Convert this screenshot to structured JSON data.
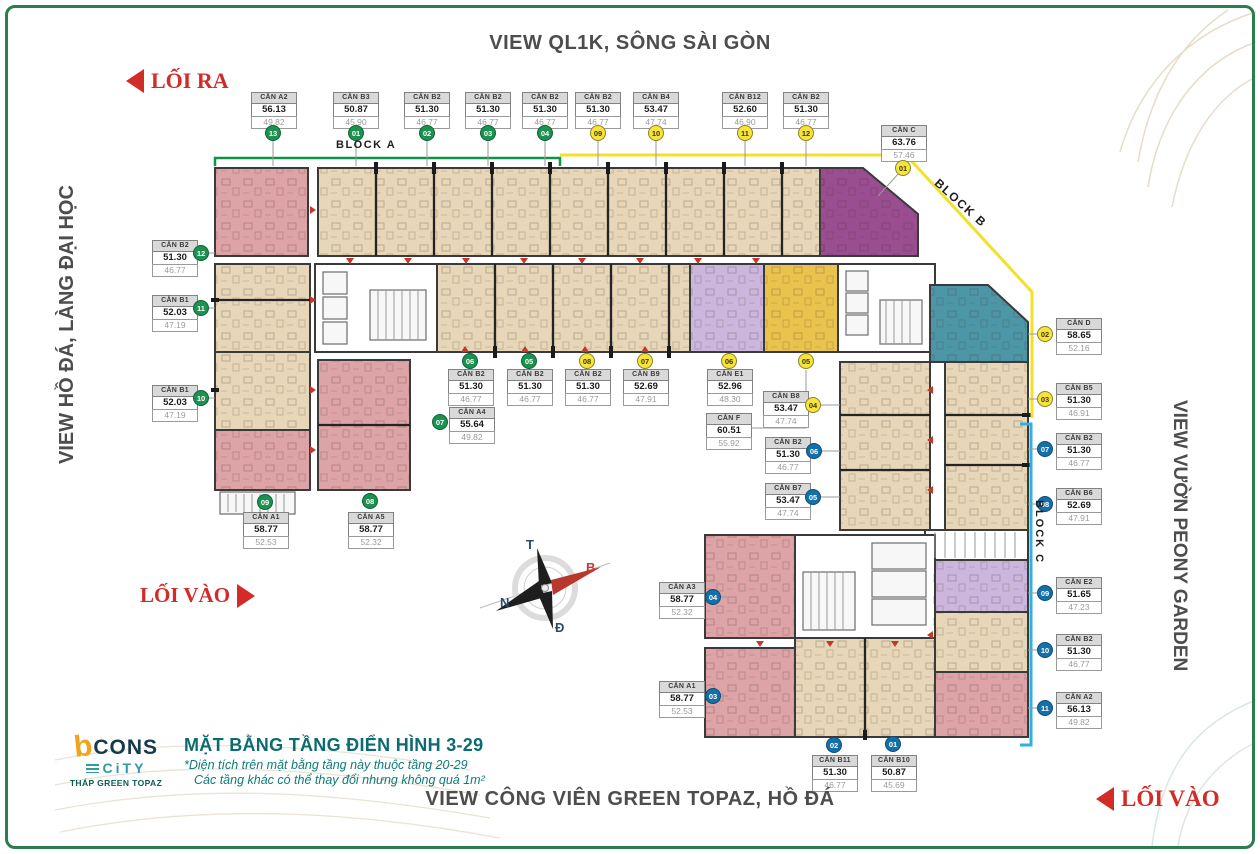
{
  "titles": {
    "top": "VIEW QL1K, SÔNG SÀI GÒN",
    "bottom": "VIEW CÔNG VIÊN GREEN TOPAZ, HỒ ĐÁ",
    "left": "VIEW HỒ ĐÁ, LÀNG ĐẠI HỌC",
    "right": "VIEW VƯỜN PEONY GARDEN"
  },
  "arrows": {
    "exit_top_left": "LỐI RA",
    "entry_left": "LỐI VÀO",
    "entry_bottom_right": "LỐI VÀO"
  },
  "blocks": {
    "a": {
      "label": "BLOCK A",
      "color": "#0f9347"
    },
    "b": {
      "label": "BLOCK B",
      "color": "#f2e02a"
    },
    "c": {
      "label": "BLOCK C",
      "color": "#2fb0e2"
    }
  },
  "compass": {
    "t": "T",
    "b": "B",
    "n": "N",
    "d": "Đ"
  },
  "legend": {
    "brand_b": "b",
    "brand": "CONS",
    "brand_city": "CiTY",
    "tower": "THÁP GREEN TOPAZ",
    "title": "MẶT BẰNG TẦNG ĐIỂN HÌNH 3-29",
    "note1": "*Diện tích trên mặt bằng tầng này thuộc tầng 20-29",
    "note2": "Các tầng khác có thể thay đổi nhưng không quá 1m²"
  },
  "badge_colors": {
    "green": "#1d9150",
    "yellow": "#f7e33c",
    "blue": "#1470a8"
  },
  "unit_colors": {
    "beige": "#e7d7b8",
    "pink": "#dda3a6",
    "purple": "#9b4d92",
    "lavender": "#cdb6dd",
    "gold": "#eac34e",
    "teal": "#4d96a8"
  },
  "units": [
    {
      "name": "CĂN A2",
      "a1": "56.13",
      "a2": "49.82",
      "badge": "13",
      "bc": "green",
      "x": 251,
      "y": 92,
      "bx": 273,
      "by": 133
    },
    {
      "name": "CĂN B3",
      "a1": "50.87",
      "a2": "45.90",
      "badge": "01",
      "bc": "green",
      "x": 333,
      "y": 92,
      "bx": 356,
      "by": 133
    },
    {
      "name": "CĂN B2",
      "a1": "51.30",
      "a2": "46.77",
      "badge": "02",
      "bc": "green",
      "x": 404,
      "y": 92,
      "bx": 427,
      "by": 133
    },
    {
      "name": "CĂN B2",
      "a1": "51.30",
      "a2": "46.77",
      "badge": "03",
      "bc": "green",
      "x": 465,
      "y": 92,
      "bx": 488,
      "by": 133
    },
    {
      "name": "CĂN B2",
      "a1": "51.30",
      "a2": "46.77",
      "badge": "04",
      "bc": "green",
      "x": 522,
      "y": 92,
      "bx": 545,
      "by": 133
    },
    {
      "name": "CĂN B2",
      "a1": "51.30",
      "a2": "46.77",
      "badge": "09",
      "bc": "yellow",
      "x": 575,
      "y": 92,
      "bx": 598,
      "by": 133
    },
    {
      "name": "CĂN B4",
      "a1": "53.47",
      "a2": "47.74",
      "badge": "10",
      "bc": "yellow",
      "x": 633,
      "y": 92,
      "bx": 656,
      "by": 133
    },
    {
      "name": "CĂN B12",
      "a1": "52.60",
      "a2": "46.90",
      "badge": "11",
      "bc": "yellow",
      "x": 722,
      "y": 92,
      "bx": 745,
      "by": 133
    },
    {
      "name": "CĂN B2",
      "a1": "51.30",
      "a2": "46.77",
      "badge": "12",
      "bc": "yellow",
      "x": 783,
      "y": 92,
      "bx": 806,
      "by": 133
    },
    {
      "name": "CĂN C",
      "a1": "63.76",
      "a2": "57.46",
      "badge": "01",
      "bc": "yellow",
      "x": 881,
      "y": 125,
      "bx": 903,
      "by": 168
    },
    {
      "name": "CĂN B2",
      "a1": "51.30",
      "a2": "46.77",
      "badge": "12",
      "bc": "green",
      "x": 152,
      "y": 240,
      "bx": 201,
      "by": 253
    },
    {
      "name": "CĂN B1",
      "a1": "52.03",
      "a2": "47.19",
      "badge": "11",
      "bc": "green",
      "x": 152,
      "y": 295,
      "bx": 201,
      "by": 308
    },
    {
      "name": "CĂN B1",
      "a1": "52.03",
      "a2": "47.19",
      "badge": "10",
      "bc": "green",
      "x": 152,
      "y": 385,
      "bx": 201,
      "by": 398
    },
    {
      "name": "CĂN B2",
      "a1": "51.30",
      "a2": "46.77",
      "badge": "06",
      "bc": "green",
      "x": 448,
      "y": 369,
      "bx": 470,
      "by": 361
    },
    {
      "name": "CĂN B2",
      "a1": "51.30",
      "a2": "46.77",
      "badge": "05",
      "bc": "green",
      "x": 507,
      "y": 369,
      "bx": 529,
      "by": 361
    },
    {
      "name": "CĂN B2",
      "a1": "51.30",
      "a2": "46.77",
      "badge": "08",
      "bc": "yellow",
      "x": 565,
      "y": 369,
      "bx": 587,
      "by": 361
    },
    {
      "name": "CĂN B9",
      "a1": "52.69",
      "a2": "47.91",
      "badge": "07",
      "bc": "yellow",
      "x": 623,
      "y": 369,
      "bx": 645,
      "by": 361
    },
    {
      "name": "CĂN A4",
      "a1": "55.64",
      "a2": "49.82",
      "badge": "07",
      "bc": "green",
      "x": 449,
      "y": 407,
      "bx": 440,
      "by": 422
    },
    {
      "name": "CĂN E1",
      "a1": "52.96",
      "a2": "48.30",
      "badge": "06",
      "bc": "yellow",
      "x": 707,
      "y": 369,
      "bx": 729,
      "by": 361
    },
    {
      "name": "CĂN F",
      "a1": "60.51",
      "a2": "55.92",
      "badge": "05",
      "bc": "yellow",
      "x": 706,
      "y": 413,
      "bx": 806,
      "by": 361
    },
    {
      "name": "CĂN B8",
      "a1": "53.47",
      "a2": "47.74",
      "badge": "04",
      "bc": "yellow",
      "x": 763,
      "y": 391,
      "bx": 813,
      "by": 405
    },
    {
      "name": "CĂN B2",
      "a1": "51.30",
      "a2": "46.77",
      "badge": "06",
      "bc": "blue",
      "x": 765,
      "y": 437,
      "bx": 814,
      "by": 451
    },
    {
      "name": "CĂN B7",
      "a1": "53.47",
      "a2": "47.74",
      "badge": "05",
      "bc": "blue",
      "x": 765,
      "y": 483,
      "bx": 813,
      "by": 497
    },
    {
      "name": "CĂN A1",
      "a1": "58.77",
      "a2": "52.53",
      "badge": "09",
      "bc": "green",
      "x": 243,
      "y": 512,
      "bx": 265,
      "by": 502
    },
    {
      "name": "CĂN A5",
      "a1": "58.77",
      "a2": "52.32",
      "badge": "08",
      "bc": "green",
      "x": 348,
      "y": 512,
      "bx": 370,
      "by": 501
    },
    {
      "name": "CĂN A3",
      "a1": "58.77",
      "a2": "52.32",
      "badge": "04",
      "bc": "blue",
      "x": 659,
      "y": 582,
      "bx": 713,
      "by": 597
    },
    {
      "name": "CĂN A1",
      "a1": "58.77",
      "a2": "52.53",
      "badge": "03",
      "bc": "blue",
      "x": 659,
      "y": 681,
      "bx": 713,
      "by": 696
    },
    {
      "name": "CĂN B11",
      "a1": "51.30",
      "a2": "46.77",
      "badge": "02",
      "bc": "blue",
      "x": 812,
      "y": 755,
      "bx": 834,
      "by": 745
    },
    {
      "name": "CĂN B10",
      "a1": "50.87",
      "a2": "45.69",
      "badge": "01",
      "bc": "blue",
      "x": 871,
      "y": 755,
      "bx": 893,
      "by": 744
    },
    {
      "name": "CĂN D",
      "a1": "58.65",
      "a2": "52.16",
      "badge": "02",
      "bc": "yellow",
      "x": 1056,
      "y": 318,
      "bx": 1045,
      "by": 334
    },
    {
      "name": "CĂN B5",
      "a1": "51.30",
      "a2": "46.91",
      "badge": "03",
      "bc": "yellow",
      "x": 1056,
      "y": 383,
      "bx": 1045,
      "by": 399
    },
    {
      "name": "CĂN B2",
      "a1": "51.30",
      "a2": "46.77",
      "badge": "07",
      "bc": "blue",
      "x": 1056,
      "y": 433,
      "bx": 1045,
      "by": 449
    },
    {
      "name": "CĂN B6",
      "a1": "52.69",
      "a2": "47.91",
      "badge": "08",
      "bc": "blue",
      "x": 1056,
      "y": 488,
      "bx": 1045,
      "by": 504
    },
    {
      "name": "CĂN E2",
      "a1": "51.65",
      "a2": "47.23",
      "badge": "09",
      "bc": "blue",
      "x": 1056,
      "y": 577,
      "bx": 1045,
      "by": 593
    },
    {
      "name": "CĂN B2",
      "a1": "51.30",
      "a2": "46.77",
      "badge": "10",
      "bc": "blue",
      "x": 1056,
      "y": 634,
      "bx": 1045,
      "by": 650
    },
    {
      "name": "CĂN A2",
      "a1": "56.13",
      "a2": "49.82",
      "badge": "11",
      "bc": "blue",
      "x": 1056,
      "y": 692,
      "bx": 1045,
      "by": 708
    }
  ]
}
